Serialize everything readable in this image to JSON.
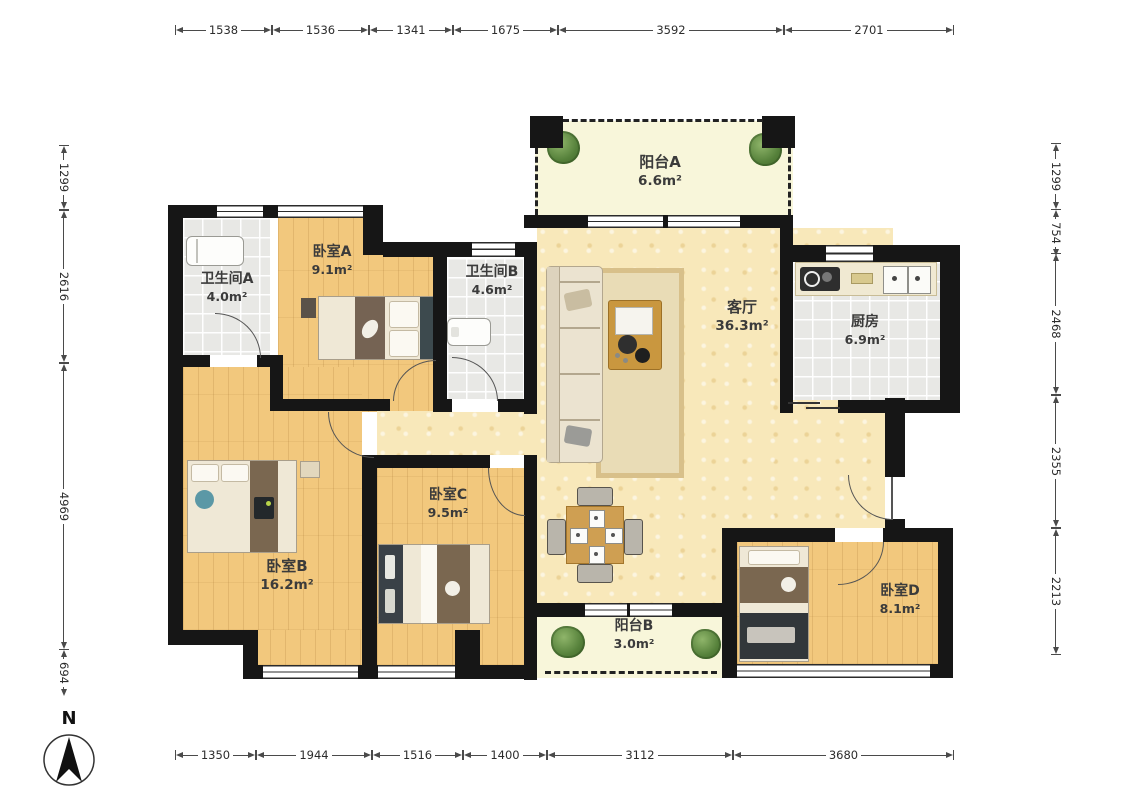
{
  "compass": {
    "north_label": "N"
  },
  "dimensions": {
    "top": [
      "1538",
      "1536",
      "1341",
      "1675",
      "3592",
      "2701"
    ],
    "bottom": [
      "1350",
      "1944",
      "1516",
      "1400",
      "3112",
      "3680"
    ],
    "left": [
      "1299",
      "2616",
      "4969",
      "694"
    ],
    "right": [
      "1299",
      "754",
      "2468",
      "2355",
      "2213"
    ]
  },
  "rooms": {
    "balcony_a": {
      "name": "阳台A",
      "area": "6.6m²"
    },
    "bathroom_a": {
      "name": "卫生间A",
      "area": "4.0m²"
    },
    "bedroom_a": {
      "name": "卧室A",
      "area": "9.1m²"
    },
    "bathroom_b": {
      "name": "卫生间B",
      "area": "4.6m²"
    },
    "living_room": {
      "name": "客厅",
      "area": "36.3m²"
    },
    "kitchen": {
      "name": "厨房",
      "area": "6.9m²"
    },
    "bedroom_b": {
      "name": "卧室B",
      "area": "16.2m²"
    },
    "bedroom_c": {
      "name": "卧室C",
      "area": "9.5m²"
    },
    "balcony_b": {
      "name": "阳台B",
      "area": "3.0m²"
    },
    "bedroom_d": {
      "name": "卧室D",
      "area": "8.1m²"
    }
  },
  "colors": {
    "wall": "#161616",
    "wood_floor": "#f2c87d",
    "living_floor": "#f8e8ba",
    "balcony_floor": "#f8f6da",
    "tile_floor": "#e8e8e5",
    "plant_green": "#55803a"
  }
}
